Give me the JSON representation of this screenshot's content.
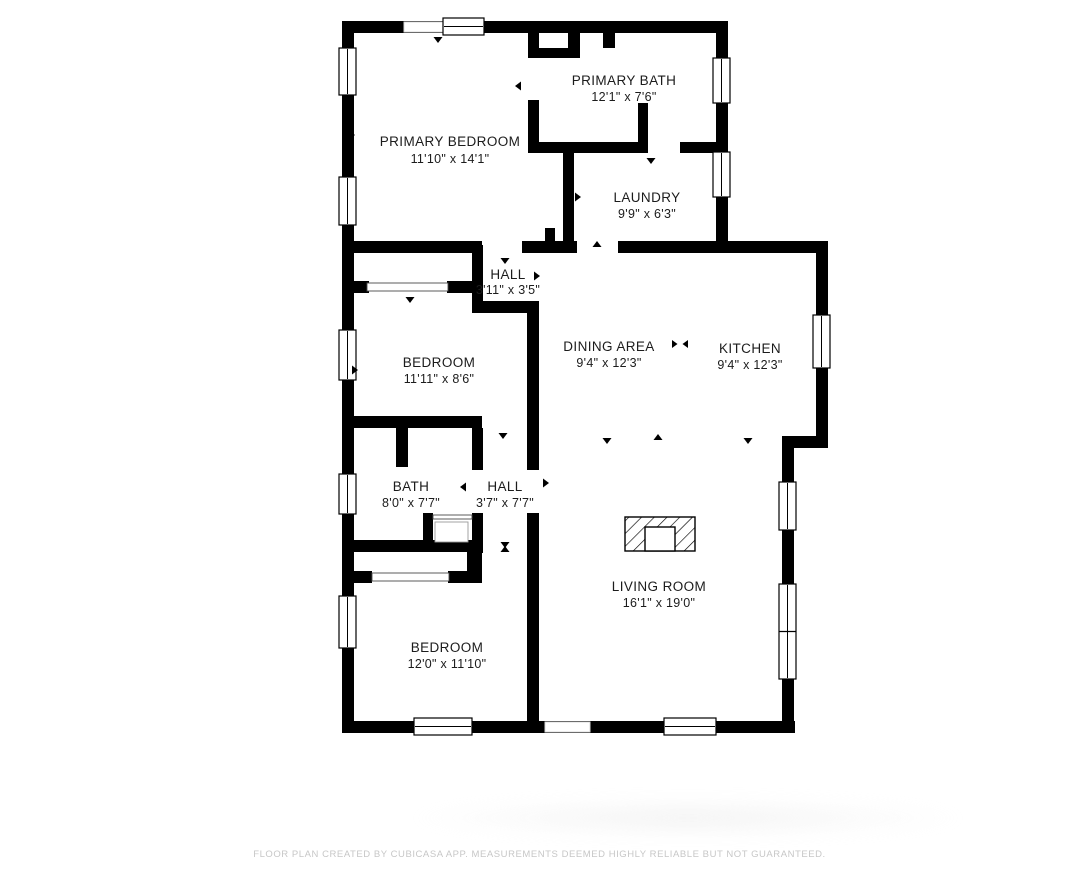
{
  "footer": {
    "disclaimer": "FLOOR PLAN CREATED BY CUBICASA APP. MEASUREMENTS DEEMED HIGHLY RELIABLE BUT NOT GUARANTEED."
  },
  "plan": {
    "colors": {
      "wall": "#000000",
      "text": "#1c1c1c",
      "window_stroke": "#000000",
      "opening_stroke": "#d9d9d9",
      "slider_stroke": "#4a4a4a",
      "fixture_stroke": "#9a9a9a"
    },
    "rooms": [
      {
        "id": "primary-bedroom",
        "name": "PRIMARY BEDROOM",
        "dims": "11'10\" x 14'1\"",
        "x": 450,
        "name_y": 146,
        "dims_y": 163
      },
      {
        "id": "primary-bath",
        "name": "PRIMARY BATH",
        "dims": "12'1\" x 7'6\"",
        "x": 624,
        "name_y": 85,
        "dims_y": 101
      },
      {
        "id": "laundry",
        "name": "LAUNDRY",
        "dims": "9'9\" x 6'3\"",
        "x": 647,
        "name_y": 202,
        "dims_y": 218
      },
      {
        "id": "hall-upper",
        "name": "HALL",
        "dims": "3'11\" x 3'5\"",
        "x": 508,
        "name_y": 279,
        "dims_y": 294
      },
      {
        "id": "bedroom-2",
        "name": "BEDROOM",
        "dims": "11'11\" x 8'6\"",
        "x": 439,
        "name_y": 367,
        "dims_y": 383
      },
      {
        "id": "dining-area",
        "name": "DINING AREA",
        "dims": "9'4\" x 12'3\"",
        "x": 609,
        "name_y": 351,
        "dims_y": 367
      },
      {
        "id": "kitchen",
        "name": "KITCHEN",
        "dims": "9'4\" x 12'3\"",
        "x": 750,
        "name_y": 353,
        "dims_y": 369
      },
      {
        "id": "bath",
        "name": "BATH",
        "dims": "8'0\" x 7'7\"",
        "x": 411,
        "name_y": 491,
        "dims_y": 507
      },
      {
        "id": "hall-lower",
        "name": "HALL",
        "dims": "3'7\" x 7'7\"",
        "x": 505,
        "name_y": 491,
        "dims_y": 507
      },
      {
        "id": "living-room",
        "name": "LIVING ROOM",
        "dims": "16'1\" x 19'0\"",
        "x": 659,
        "name_y": 591,
        "dims_y": 607
      },
      {
        "id": "bedroom-3",
        "name": "BEDROOM",
        "dims": "12'0\" x 11'10\"",
        "x": 447,
        "name_y": 652,
        "dims_y": 668
      }
    ],
    "walls": [
      [
        342,
        21,
        386,
        12
      ],
      [
        342,
        21,
        12,
        712
      ],
      [
        342,
        721,
        453,
        12
      ],
      [
        716,
        21,
        12,
        232
      ],
      [
        816,
        241,
        12,
        207
      ],
      [
        782,
        436,
        46,
        12
      ],
      [
        782,
        436,
        12,
        297
      ],
      [
        342,
        241,
        140,
        12
      ],
      [
        522,
        241,
        55,
        12
      ],
      [
        618,
        241,
        210,
        12
      ],
      [
        528,
        21,
        11,
        37
      ],
      [
        538,
        48,
        42,
        10
      ],
      [
        568,
        21,
        12,
        37
      ],
      [
        603,
        21,
        12,
        27
      ],
      [
        528,
        100,
        11,
        53
      ],
      [
        528,
        142,
        120,
        11
      ],
      [
        680,
        142,
        48,
        11
      ],
      [
        638,
        103,
        10,
        50
      ],
      [
        563,
        153,
        11,
        92
      ],
      [
        545,
        228,
        10,
        17
      ],
      [
        472,
        245,
        11,
        68
      ],
      [
        342,
        281,
        27,
        12
      ],
      [
        447,
        281,
        26,
        12
      ],
      [
        472,
        301,
        66,
        12
      ],
      [
        527,
        301,
        12,
        169
      ],
      [
        342,
        416,
        140,
        12
      ],
      [
        396,
        428,
        12,
        39
      ],
      [
        472,
        428,
        11,
        42
      ],
      [
        472,
        513,
        11,
        40
      ],
      [
        423,
        513,
        10,
        30
      ],
      [
        342,
        540,
        140,
        12
      ],
      [
        467,
        540,
        15,
        43
      ],
      [
        527,
        513,
        12,
        220
      ],
      [
        342,
        571,
        30,
        12
      ],
      [
        448,
        571,
        34,
        12
      ]
    ],
    "windows": [
      {
        "x": 443,
        "y": 18,
        "w": 41,
        "h": 17,
        "o": "h",
        "split": false
      },
      {
        "x": 339,
        "y": 48,
        "w": 17,
        "h": 47,
        "o": "v",
        "split": false
      },
      {
        "x": 339,
        "y": 177,
        "w": 17,
        "h": 48,
        "o": "v",
        "split": false
      },
      {
        "x": 339,
        "y": 330,
        "w": 17,
        "h": 50,
        "o": "v",
        "split": false
      },
      {
        "x": 339,
        "y": 474,
        "w": 17,
        "h": 40,
        "o": "v",
        "split": false
      },
      {
        "x": 339,
        "y": 596,
        "w": 17,
        "h": 52,
        "o": "v",
        "split": false
      },
      {
        "x": 414,
        "y": 718,
        "w": 58,
        "h": 17,
        "o": "h",
        "split": false
      },
      {
        "x": 664,
        "y": 718,
        "w": 52,
        "h": 17,
        "o": "h",
        "split": false
      },
      {
        "x": 713,
        "y": 58,
        "w": 17,
        "h": 45,
        "o": "v",
        "split": false
      },
      {
        "x": 713,
        "y": 152,
        "w": 17,
        "h": 45,
        "o": "v",
        "split": false
      },
      {
        "x": 813,
        "y": 315,
        "w": 17,
        "h": 53,
        "o": "v",
        "split": false
      },
      {
        "x": 779,
        "y": 482,
        "w": 17,
        "h": 48,
        "o": "v",
        "split": false
      },
      {
        "x": 779,
        "y": 584,
        "w": 17,
        "h": 95,
        "o": "v",
        "split": true
      }
    ],
    "openings": [
      [
        404,
        22,
        39,
        10
      ],
      [
        545,
        722,
        45,
        10
      ]
    ],
    "sliders": [
      [
        367,
        283,
        81,
        8
      ],
      [
        372,
        573,
        77,
        8
      ],
      [
        433,
        515,
        39,
        4
      ]
    ],
    "fixtures": [
      [
        435,
        522,
        33,
        20
      ]
    ],
    "arrows": [
      [
        438,
        37,
        "down"
      ],
      [
        521,
        86,
        "left"
      ],
      [
        651,
        158,
        "down"
      ],
      [
        575,
        197,
        "right"
      ],
      [
        597,
        247,
        "up"
      ],
      [
        505,
        258,
        "down"
      ],
      [
        410,
        297,
        "down"
      ],
      [
        478,
        276,
        "left"
      ],
      [
        534,
        276,
        "right"
      ],
      [
        503,
        433,
        "down"
      ],
      [
        466,
        487,
        "left"
      ],
      [
        543,
        483,
        "right"
      ],
      [
        505,
        542,
        "down"
      ],
      [
        505,
        552,
        "up"
      ],
      [
        607,
        438,
        "down"
      ],
      [
        658,
        440,
        "up"
      ],
      [
        748,
        438,
        "down"
      ],
      [
        658,
        721,
        "down"
      ],
      [
        349,
        135,
        "right"
      ],
      [
        352,
        370,
        "right"
      ]
    ],
    "divider_symbol": {
      "x": 680,
      "y": 344
    },
    "fireplace": {
      "outer": [
        625,
        517,
        70,
        34
      ],
      "inner": [
        645,
        527,
        30,
        24
      ]
    }
  }
}
